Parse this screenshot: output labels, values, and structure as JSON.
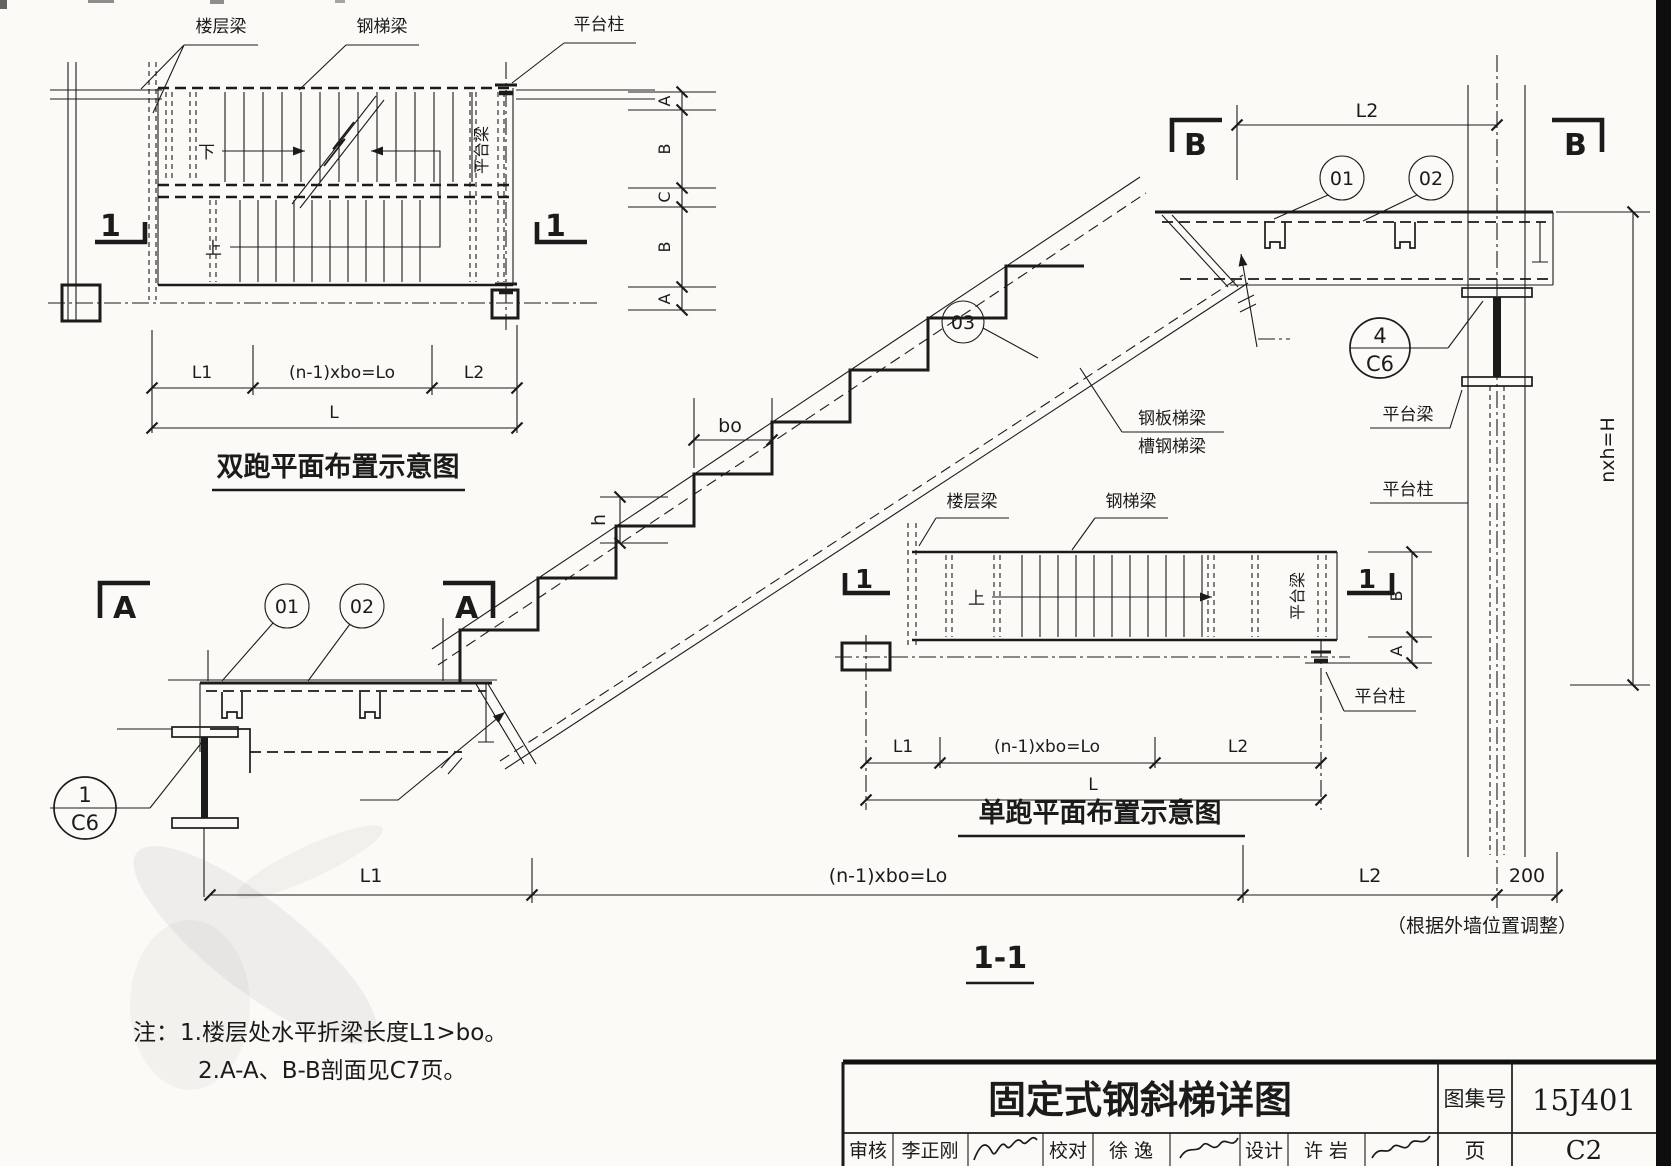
{
  "page": {
    "background": "#fbfaf6",
    "ink": "#1b1b1b"
  },
  "shared": {
    "labels": {
      "floor_beam": "楼层梁",
      "stair_beam": "钢梯梁",
      "platform_col": "平台柱",
      "platform_beam": "平台梁",
      "down": "下",
      "up": "上",
      "plate_beam": "钢板梯梁",
      "channel_beam": "槽钢梯梁"
    },
    "dims": {
      "l1": "L1",
      "lo": "(n-1)xbo=Lo",
      "l2": "L2",
      "l": "L",
      "bo": "bo",
      "h": "h",
      "height": "nxh=H",
      "wall": "200"
    },
    "markers": {
      "a": "A",
      "b": "B",
      "c": "C",
      "one": "1"
    },
    "callouts": {
      "c01": "01",
      "c02": "02",
      "c03": "03",
      "four": "4",
      "one": "1",
      "ref": "C6"
    }
  },
  "double_run_plan": {
    "title": "双跑平面布置示意图",
    "side_dims": [
      "A",
      "B",
      "C",
      "B",
      "A"
    ]
  },
  "single_run_plan": {
    "title": "单跑平面布置示意图",
    "side_dims": [
      "B",
      "A"
    ]
  },
  "section": {
    "title": "1-1",
    "wall_note": "（根据外墙位置调整）"
  },
  "notes": {
    "prefix": "注：",
    "items": [
      "1.楼层处水平折梁长度L1>bo。",
      "2.A-A、B-B剖面见C7页。"
    ]
  },
  "title_block": {
    "title": "固定式钢斜梯详图",
    "atlas_label": "图集号",
    "atlas_no": "15J401",
    "page_label": "页",
    "page_no": "C2",
    "review_label": "审核",
    "review_name": "李正刚",
    "check_label": "校对",
    "check_name": "徐 逸",
    "design_label": "设计",
    "design_name": "许 岩"
  }
}
